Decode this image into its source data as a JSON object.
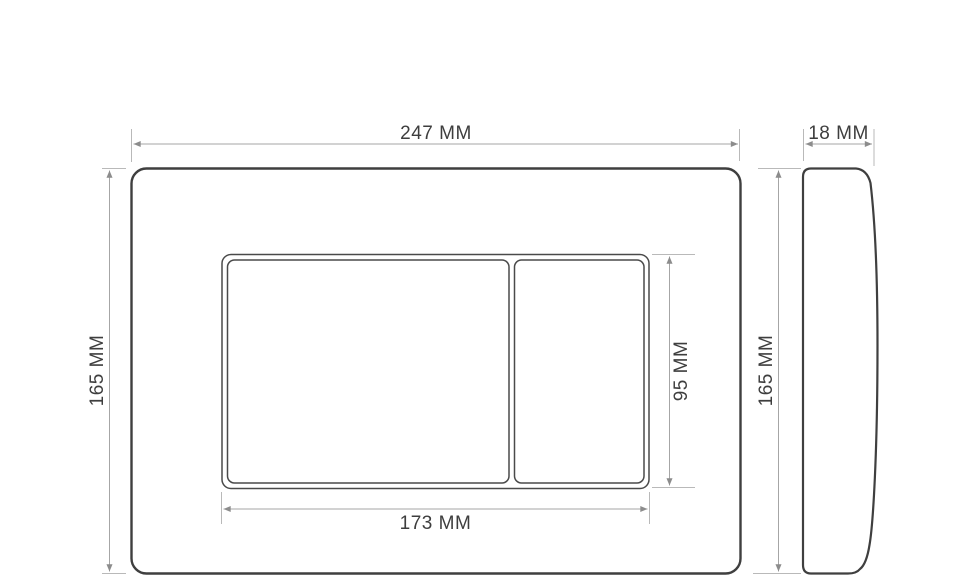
{
  "front_view": {
    "plate_width_label": "247 MM",
    "plate_height_label": "165 MM",
    "buttons_width_label": "173 MM",
    "buttons_height_label": "95 MM"
  },
  "side_view": {
    "depth_label": "18 MM",
    "height_label": "165 MM"
  },
  "colors": {
    "background": "#ffffff",
    "plate_outline": "#3f3f3f",
    "button_outline": "#4a4a4a",
    "extension_line": "#b9b9b9",
    "dimension_line": "#a6a6a6",
    "arrowhead": "#8c8c8c",
    "label_text": "#3e3e3e"
  }
}
